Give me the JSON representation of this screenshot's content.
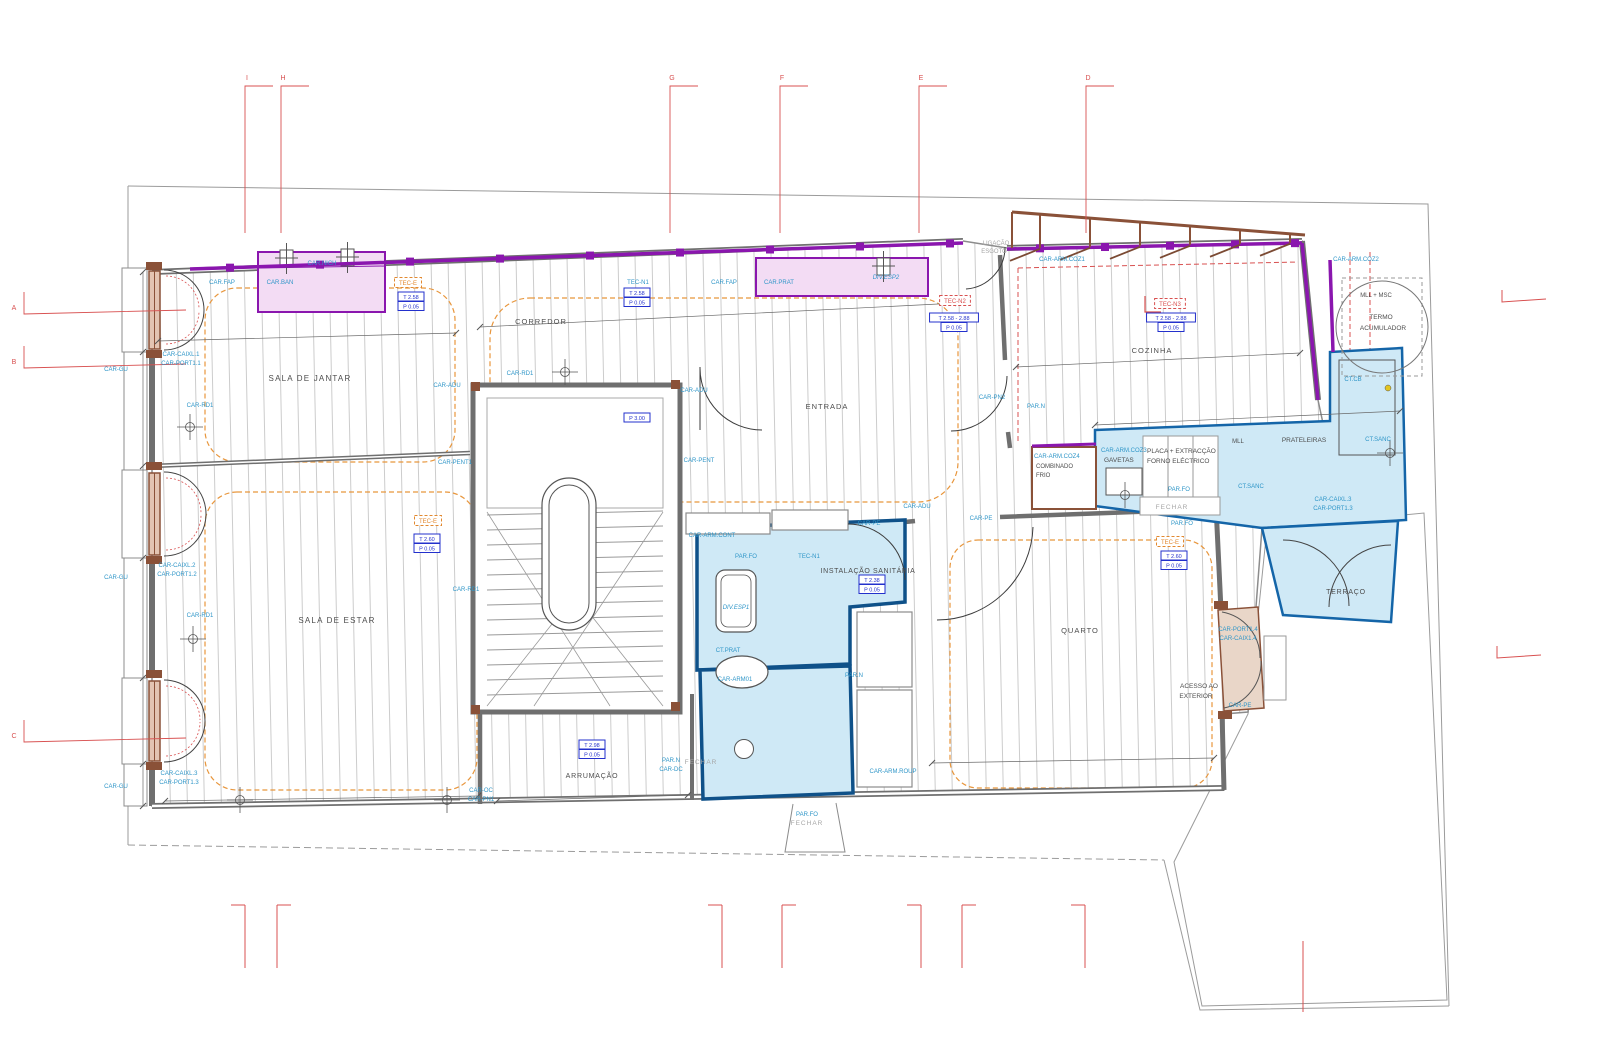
{
  "page": {
    "title": "Planta de arquitectura - piso"
  },
  "colors": {
    "cyan": "#2f96c8",
    "gray": "#4d4d4d",
    "muted": "#a6a6a6",
    "blue": "#2330cc",
    "red": "#d85050",
    "orange": "#e2882f",
    "purple": "#8a16ae",
    "blue_fill": "#cfe9f6",
    "pink_fill": "#f3dcf4",
    "tan_fill": "#e9d6c8",
    "wood": "#8a5138"
  },
  "labels": [
    {
      "n": "room-sala-de-jantar",
      "t": "SALA DE JANTAR",
      "x": 310,
      "y": 381,
      "c": "gray",
      "fs": 8,
      "ls": 1.2
    },
    {
      "n": "room-corredor",
      "t": "CORREDOR",
      "x": 541,
      "y": 324,
      "c": "gray",
      "fs": 7.5,
      "ls": 1
    },
    {
      "n": "room-entrada",
      "t": "ENTRADA",
      "x": 827,
      "y": 409,
      "c": "gray",
      "fs": 7.5,
      "ls": 1
    },
    {
      "n": "room-cozinha",
      "t": "COZINHA",
      "x": 1152,
      "y": 353,
      "c": "gray",
      "fs": 7.5,
      "ls": 1
    },
    {
      "n": "room-sala-de-estar",
      "t": "SALA DE ESTAR",
      "x": 337,
      "y": 623,
      "c": "gray",
      "fs": 8,
      "ls": 1.2
    },
    {
      "n": "room-instalacao-sanitaria",
      "t": "INSTALAÇÃO SANITÁRIA",
      "x": 868,
      "y": 573,
      "c": "gray",
      "fs": 7,
      "ls": 0.6
    },
    {
      "n": "room-quarto",
      "t": "QUARTO",
      "x": 1080,
      "y": 633,
      "c": "gray",
      "fs": 7.5,
      "ls": 1
    },
    {
      "n": "room-arrumacao",
      "t": "ARRUMAÇÃO",
      "x": 592,
      "y": 778,
      "c": "gray",
      "fs": 7,
      "ls": 0.8
    },
    {
      "n": "room-terraco",
      "t": "TERRAÇO",
      "x": 1346,
      "y": 594,
      "c": "gray",
      "fs": 7,
      "ls": 0.8
    },
    {
      "n": "label-acesso-1",
      "t": "ACESSO AO",
      "x": 1199,
      "y": 688,
      "c": "gray",
      "fs": 6.5
    },
    {
      "n": "label-acesso-2",
      "t": "EXTERIOR",
      "x": 1196,
      "y": 698,
      "c": "gray",
      "fs": 6.5
    },
    {
      "n": "label-termo-1",
      "t": "TERMO",
      "x": 1381,
      "y": 319,
      "c": "gray",
      "fs": 6.5
    },
    {
      "n": "label-termo-2",
      "t": "ACUMULADOR",
      "x": 1383,
      "y": 330,
      "c": "gray",
      "fs": 6.5
    },
    {
      "n": "label-mll-msc",
      "t": "MLL + MSC",
      "x": 1376,
      "y": 297,
      "c": "gray",
      "fs": 6
    },
    {
      "n": "label-combinado",
      "t": "COMBINADO",
      "x": 1036,
      "y": 468,
      "c": "gray",
      "fs": 6,
      "a": "start"
    },
    {
      "n": "label-frio",
      "t": "FRIO",
      "x": 1036,
      "y": 477,
      "c": "gray",
      "fs": 6,
      "a": "start"
    },
    {
      "n": "label-gavetas",
      "t": "GAVETAS",
      "x": 1104,
      "y": 462,
      "c": "gray",
      "fs": 6.5,
      "a": "start"
    },
    {
      "n": "label-placa-extraccao",
      "t": "PLACA + EXTRACÇÃO",
      "x": 1147,
      "y": 453,
      "c": "gray",
      "fs": 6.5,
      "a": "start"
    },
    {
      "n": "label-forno-electrico",
      "t": "FORNO ELÉCTRICO",
      "x": 1147,
      "y": 463,
      "c": "gray",
      "fs": 6.5,
      "a": "start"
    },
    {
      "n": "label-mll",
      "t": "MLL",
      "x": 1238,
      "y": 443,
      "c": "gray",
      "fs": 6
    },
    {
      "n": "label-prateleiras",
      "t": "PRATELEIRAS",
      "x": 1304,
      "y": 442,
      "c": "gray",
      "fs": 6.5
    },
    {
      "n": "label-ligacao",
      "t": "LIGAÇÃO",
      "x": 996,
      "y": 245,
      "c": "muted",
      "fs": 6
    },
    {
      "n": "label-esgoto",
      "t": "ESGOTO",
      "x": 994,
      "y": 253,
      "c": "muted",
      "fs": 6
    },
    {
      "n": "label-fechar-1",
      "t": "FECHAR",
      "x": 1172,
      "y": 509,
      "c": "muted",
      "fs": 6.5,
      "ls": 1
    },
    {
      "n": "label-fechar-2",
      "t": "FECHAR",
      "x": 701,
      "y": 764,
      "c": "muted",
      "fs": 6.5,
      "ls": 1
    },
    {
      "n": "label-fechar-3",
      "t": "FECHAR",
      "x": 807,
      "y": 825,
      "c": "muted",
      "fs": 6.5,
      "ls": 1
    },
    {
      "n": "label-car-fap-1",
      "t": "CAR.FAP",
      "x": 222,
      "y": 284,
      "c": "cyan"
    },
    {
      "n": "label-car-ban",
      "t": "CAR.BAN",
      "x": 280,
      "y": 284,
      "c": "cyan"
    },
    {
      "n": "label-car-nich",
      "t": "CAR.NICH",
      "x": 322,
      "y": 265,
      "c": "cyan"
    },
    {
      "n": "label-car-fap-2",
      "t": "CAR.FAP",
      "x": 724,
      "y": 284,
      "c": "cyan"
    },
    {
      "n": "label-car-prat",
      "t": "CAR.PRAT",
      "x": 779,
      "y": 284,
      "c": "cyan"
    },
    {
      "n": "label-div-esp2",
      "t": "DIV.ESP2",
      "x": 886,
      "y": 279,
      "c": "cyan",
      "i": true
    },
    {
      "n": "label-car-arm-coz1",
      "t": "CAR-ARM.COZ1",
      "x": 1062,
      "y": 261,
      "c": "cyan"
    },
    {
      "n": "label-car-arm-coz2",
      "t": "CAR-ARM.COZ2",
      "x": 1356,
      "y": 261,
      "c": "cyan"
    },
    {
      "n": "label-car-arm-coz3",
      "t": "CAR-ARM.COZ3",
      "x": 1101,
      "y": 452,
      "c": "cyan",
      "a": "start"
    },
    {
      "n": "label-car-arm-coz4",
      "t": "CAR-ARM.COZ4",
      "x": 1034,
      "y": 458,
      "c": "cyan",
      "a": "start"
    },
    {
      "n": "label-ct-cb",
      "t": "CT.CB",
      "x": 1353,
      "y": 381,
      "c": "cyan"
    },
    {
      "n": "label-ct-sanc-1",
      "t": "CT.SANC",
      "x": 1378,
      "y": 441,
      "c": "cyan"
    },
    {
      "n": "label-ct-sanc-2",
      "t": "CT.SANC",
      "x": 1251,
      "y": 488,
      "c": "cyan"
    },
    {
      "n": "label-par-n-1",
      "t": "PAR.N",
      "x": 1036,
      "y": 408,
      "c": "cyan"
    },
    {
      "n": "label-car-pn2",
      "t": "CAR-PN2",
      "x": 992,
      "y": 399,
      "c": "cyan"
    },
    {
      "n": "label-car-adu-1",
      "t": "CAR-ADU",
      "x": 447,
      "y": 387,
      "c": "cyan"
    },
    {
      "n": "label-car-adu-2",
      "t": "CAR-ADU",
      "x": 694,
      "y": 392,
      "c": "cyan"
    },
    {
      "n": "label-car-adu-3",
      "t": "CAR-ADU",
      "x": 917,
      "y": 508,
      "c": "cyan"
    },
    {
      "n": "label-car-pent1",
      "t": "CAR-PENT1",
      "x": 455,
      "y": 464,
      "c": "cyan"
    },
    {
      "n": "label-car-pent2",
      "t": "CAR-PENT",
      "x": 699,
      "y": 462,
      "c": "cyan"
    },
    {
      "n": "label-car-rd1-a",
      "t": "CAR-RD1",
      "x": 200,
      "y": 407,
      "c": "cyan"
    },
    {
      "n": "label-car-rd1-b",
      "t": "CAR-RD1",
      "x": 520,
      "y": 375,
      "c": "cyan"
    },
    {
      "n": "label-car-rd1-c",
      "t": "CAR-RD1",
      "x": 200,
      "y": 617,
      "c": "cyan"
    },
    {
      "n": "label-car-rd1-d",
      "t": "CAR-RD1",
      "x": 466,
      "y": 591,
      "c": "cyan"
    },
    {
      "n": "label-car-gu-1",
      "t": "CAR-GU",
      "x": 116,
      "y": 371,
      "c": "cyan"
    },
    {
      "n": "label-car-gu-2",
      "t": "CAR-GU",
      "x": 116,
      "y": 579,
      "c": "cyan"
    },
    {
      "n": "label-car-gu-3",
      "t": "CAR-GU",
      "x": 116,
      "y": 788,
      "c": "cyan"
    },
    {
      "n": "label-w1-caixl",
      "t": "CAR-CAIXL.1",
      "x": 181,
      "y": 356,
      "c": "cyan"
    },
    {
      "n": "label-w1-port",
      "t": "CAR-PORT1.1",
      "x": 181,
      "y": 365,
      "c": "cyan"
    },
    {
      "n": "label-w2-caixl",
      "t": "CAR-CAIXL.2",
      "x": 177,
      "y": 567,
      "c": "cyan"
    },
    {
      "n": "label-w2-port",
      "t": "CAR-PORT1.2",
      "x": 177,
      "y": 576,
      "c": "cyan"
    },
    {
      "n": "label-w3-caixl",
      "t": "CAR-CAIXL.3",
      "x": 179,
      "y": 775,
      "c": "cyan"
    },
    {
      "n": "label-w3-port",
      "t": "CAR-PORT1.3",
      "x": 179,
      "y": 784,
      "c": "cyan"
    },
    {
      "n": "label-kd-caixl",
      "t": "CAR-CAIXL.3",
      "x": 1333,
      "y": 501,
      "c": "cyan"
    },
    {
      "n": "label-kd-port",
      "t": "CAR-PORT1.3",
      "x": 1333,
      "y": 510,
      "c": "cyan"
    },
    {
      "n": "label-ad-port",
      "t": "CAR-PORT1.4",
      "x": 1238,
      "y": 631,
      "c": "cyan"
    },
    {
      "n": "label-ad-caix",
      "t": "CAR-CAIX1.4",
      "x": 1238,
      "y": 640,
      "c": "cyan"
    },
    {
      "n": "label-car-pe-1",
      "t": "CAR-PE",
      "x": 869,
      "y": 525,
      "c": "cyan"
    },
    {
      "n": "label-car-pe-2",
      "t": "CAR-PE",
      "x": 981,
      "y": 520,
      "c": "cyan"
    },
    {
      "n": "label-car-pe-3",
      "t": "CAR-PE",
      "x": 1240,
      "y": 707,
      "c": "cyan"
    },
    {
      "n": "label-car-arm-cont",
      "t": "CAR-ARM.CONT",
      "x": 712,
      "y": 537,
      "c": "cyan"
    },
    {
      "n": "label-par-fo-1",
      "t": "PAR.FO",
      "x": 746,
      "y": 558,
      "c": "cyan"
    },
    {
      "n": "label-div-esp1",
      "t": "DIV.ESP1",
      "x": 736,
      "y": 609,
      "c": "cyan",
      "i": true
    },
    {
      "n": "label-ct-prat",
      "t": "CT.PRAT",
      "x": 728,
      "y": 652,
      "c": "cyan"
    },
    {
      "n": "label-car-arm01",
      "t": "CAR-ARM01",
      "x": 735,
      "y": 681,
      "c": "cyan"
    },
    {
      "n": "label-par-n-2",
      "t": "PAR.N",
      "x": 854,
      "y": 677,
      "c": "cyan"
    },
    {
      "n": "label-par-n-3",
      "t": "PAR.N",
      "x": 671,
      "y": 762,
      "c": "cyan"
    },
    {
      "n": "label-car-dc",
      "t": "CAR-DC",
      "x": 671,
      "y": 771,
      "c": "cyan"
    },
    {
      "n": "label-car-oc",
      "t": "CAR-OC",
      "x": 481,
      "y": 792,
      "c": "cyan"
    },
    {
      "n": "label-car-pn1",
      "t": "CAR-PN1",
      "x": 481,
      "y": 801,
      "c": "cyan"
    },
    {
      "n": "label-car-arm-roup",
      "t": "CAR-ARM.ROUP",
      "x": 893,
      "y": 773,
      "c": "cyan"
    },
    {
      "n": "label-par-fo-2",
      "t": "PAR.FO",
      "x": 1179,
      "y": 491,
      "c": "cyan"
    },
    {
      "n": "label-par-fo-3",
      "t": "PAR.FO",
      "x": 1182,
      "y": 525,
      "c": "cyan"
    },
    {
      "n": "label-par-fo-4",
      "t": "PAR.FO",
      "x": 807,
      "y": 816,
      "c": "cyan"
    }
  ],
  "tec_tags": [
    {
      "n": "tec-e-jantar",
      "t": "TEC-E",
      "x": 408,
      "y": 285,
      "s": "orange"
    },
    {
      "n": "tec-e-estar",
      "t": "TEC-E",
      "x": 428,
      "y": 523,
      "s": "orange"
    },
    {
      "n": "tec-e-quarto",
      "t": "TEC-E",
      "x": 1170,
      "y": 544,
      "s": "orange"
    },
    {
      "n": "tec-n1-corredor",
      "t": "TEC-N1",
      "x": 638,
      "y": 284,
      "s": "cyan"
    },
    {
      "n": "tec-n1-is",
      "t": "TEC-N1",
      "x": 809,
      "y": 558,
      "s": "cyan"
    },
    {
      "n": "tec-n2-entrada",
      "t": "TEC-N2",
      "x": 955,
      "y": 303,
      "s": "red"
    },
    {
      "n": "tec-n3-cozinha",
      "t": "TEC-N3",
      "x": 1170,
      "y": 306,
      "s": "red"
    }
  ],
  "level_tags": [
    {
      "n": "lvl-jantar",
      "x": 411,
      "y": 299,
      "lines": [
        "T 2.58",
        "P 0.05"
      ]
    },
    {
      "n": "lvl-corredor",
      "x": 637,
      "y": 295,
      "lines": [
        "T 2.58",
        "P 0.05"
      ]
    },
    {
      "n": "lvl-entrada",
      "x": 954,
      "y": 320,
      "lines": [
        "T 2.58 - 2.88",
        "P 0.05"
      ]
    },
    {
      "n": "lvl-cozinha",
      "x": 1171,
      "y": 320,
      "lines": [
        "T 2.58 - 2.88",
        "P 0.05"
      ]
    },
    {
      "n": "lvl-is",
      "x": 872,
      "y": 582,
      "lines": [
        "T 2.38",
        "P 0.05"
      ]
    },
    {
      "n": "lvl-estar",
      "x": 427,
      "y": 541,
      "lines": [
        "T 2.60",
        "P 0.05"
      ]
    },
    {
      "n": "lvl-quarto",
      "x": 1174,
      "y": 558,
      "lines": [
        "T 2.60",
        "P 0.05"
      ]
    },
    {
      "n": "lvl-arrumacao",
      "x": 592,
      "y": 747,
      "lines": [
        "T 2.98",
        "P 0.05"
      ]
    },
    {
      "n": "lvl-escada",
      "x": 637,
      "y": 420,
      "lines": [
        "P 3.00"
      ]
    }
  ],
  "grid": {
    "top": [
      {
        "l": "I",
        "x": 247
      },
      {
        "l": "H",
        "x": 283
      },
      {
        "l": "G",
        "x": 672
      },
      {
        "l": "F",
        "x": 782
      },
      {
        "l": "E",
        "x": 921
      },
      {
        "l": "D",
        "x": 1088
      }
    ],
    "left": [
      {
        "l": "A",
        "y": 308
      },
      {
        "l": "B",
        "y": 362
      },
      {
        "l": "C",
        "y": 736
      }
    ]
  }
}
